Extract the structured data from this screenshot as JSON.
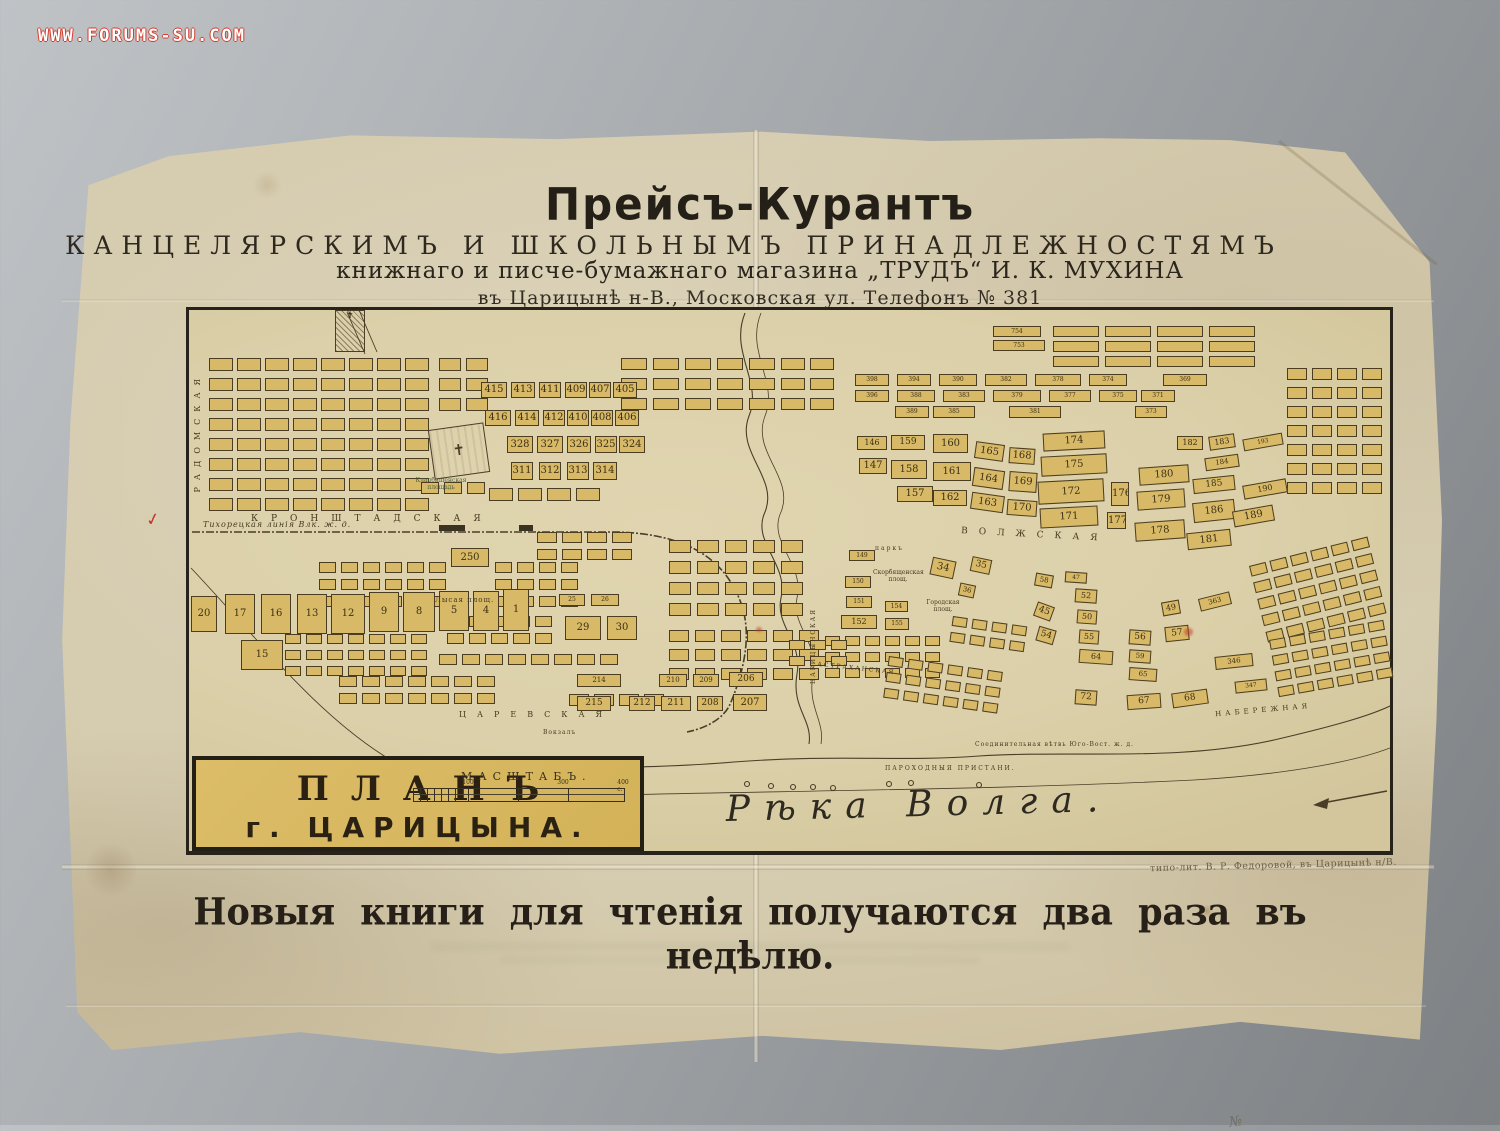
{
  "watermark": "WWW.FORUMS-SU.COM",
  "header": {
    "title": "Прейсъ-Курантъ",
    "line2": "КАНЦЕЛЯРСКИМЪ И ШКОЛЬНЫМЪ ПРИНАДЛЕЖНОСТЯМЪ",
    "line3": "книжнаго и писче-бумажнаго магазина „ТРУДЪ“ И. К. МУХИНА",
    "line4": "въ Царицынѣ н-В., Московская ул. Телефонъ № 381"
  },
  "map": {
    "plan_label_line1": "ПЛАНЪ",
    "plan_label_line2": "г. ЦАРИЦЫНА.",
    "scale": {
      "label": "МАСШТАБЪ.",
      "ticks": [
        [
          "100",
          55
        ],
        [
          "300",
          150
        ],
        [
          "400 с.",
          210
        ]
      ]
    },
    "river_label": "Рѣка Волга.",
    "prison_mark": "✝",
    "cemetery_mark": "✝",
    "pencil_note": "№",
    "red_check": "✓",
    "streets": [
      {
        "t": "РАДОМСКАЯ",
        "x": 4,
        "y": 62,
        "fs": 8,
        "ls": 7,
        "v": 1
      },
      {
        "t": "КРОНШТАДСКАЯ",
        "x": 62,
        "y": 204,
        "fs": 9,
        "ls": 13
      },
      {
        "t": "Тихорецкая линія Влк. ж. д.",
        "x": 14,
        "y": 210,
        "fs": 8,
        "ls": 1,
        "i": 1
      },
      {
        "t": "ВОЛЖСКАЯ",
        "x": 772,
        "y": 220,
        "fs": 9,
        "ls": 11,
        "r": 3
      },
      {
        "t": "ЦАРЕВСКАЯ",
        "x": 270,
        "y": 400,
        "fs": 8,
        "ls": 11
      },
      {
        "t": "НАБЕРЕЖНАЯ",
        "x": 1026,
        "y": 396,
        "fs": 7,
        "ls": 4,
        "r": -5
      },
      {
        "t": "Кладбищенская площадь",
        "x": 220,
        "y": 168,
        "fs": 6,
        "w": 64,
        "c": "#51603a"
      },
      {
        "t": "Лысая площ.",
        "x": 246,
        "y": 286,
        "fs": 7,
        "ls": 1
      },
      {
        "t": "Городская площ.",
        "x": 736,
        "y": 290,
        "fs": 6,
        "w": 36
      },
      {
        "t": "Скорбященская площ.",
        "x": 684,
        "y": 260,
        "fs": 6,
        "w": 50
      },
      {
        "t": "паркъ",
        "x": 686,
        "y": 236,
        "fs": 6,
        "ls": 2
      },
      {
        "t": "АСТРАХАНСКАЯ",
        "x": 628,
        "y": 356,
        "fs": 6,
        "ls": 2,
        "r": 6
      },
      {
        "t": "ЦАРИЦЫНСКАЯ",
        "x": 622,
        "y": 298,
        "fs": 6,
        "ls": 2,
        "v": 1
      },
      {
        "t": "Соединительная вѣтвь Юго-Вост. ж. д.",
        "x": 786,
        "y": 432,
        "fs": 6,
        "ls": 1
      },
      {
        "t": "ПАРОХОДНЫЯ ПРИСТАНИ.",
        "x": 696,
        "y": 456,
        "fs": 6,
        "ls": 2
      },
      {
        "t": "Вокзалъ",
        "x": 354,
        "y": 420,
        "fs": 6,
        "ls": 1
      }
    ],
    "blocks": [
      [
        "20",
        2,
        286,
        26,
        36
      ],
      [
        "17",
        36,
        284,
        30,
        40
      ],
      [
        "16",
        72,
        284,
        30,
        40
      ],
      [
        "13",
        108,
        284,
        30,
        40
      ],
      [
        "12",
        142,
        284,
        34,
        40
      ],
      [
        "9",
        180,
        282,
        30,
        40
      ],
      [
        "8",
        214,
        282,
        32,
        40
      ],
      [
        "5",
        250,
        281,
        30,
        40
      ],
      [
        "4",
        284,
        281,
        26,
        40
      ],
      [
        "1",
        314,
        279,
        26,
        42
      ],
      [
        "15",
        52,
        330,
        42,
        30
      ],
      [
        "250",
        262,
        238,
        38,
        19
      ],
      [
        "25",
        370,
        284,
        26,
        12
      ],
      [
        "26",
        402,
        284,
        28,
        12
      ],
      [
        "29",
        376,
        306,
        36,
        24
      ],
      [
        "30",
        418,
        306,
        30,
        24
      ],
      [
        "214",
        388,
        364,
        44,
        13
      ],
      [
        "210",
        470,
        364,
        28,
        13
      ],
      [
        "209",
        504,
        364,
        26,
        13
      ],
      [
        "206",
        540,
        362,
        34,
        15
      ],
      [
        "215",
        388,
        386,
        34,
        15
      ],
      [
        "212",
        440,
        386,
        26,
        15
      ],
      [
        "211",
        472,
        386,
        30,
        15
      ],
      [
        "208",
        508,
        386,
        26,
        15
      ],
      [
        "207",
        544,
        384,
        34,
        17
      ],
      [
        "415",
        292,
        72,
        26,
        16
      ],
      [
        "413",
        322,
        72,
        24,
        16
      ],
      [
        "411",
        350,
        72,
        22,
        16
      ],
      [
        "409",
        376,
        72,
        22,
        16
      ],
      [
        "407",
        400,
        72,
        22,
        16
      ],
      [
        "405",
        424,
        72,
        24,
        16
      ],
      [
        "416",
        296,
        100,
        26,
        16
      ],
      [
        "414",
        326,
        100,
        24,
        16
      ],
      [
        "412",
        354,
        100,
        22,
        16
      ],
      [
        "410",
        378,
        100,
        22,
        16
      ],
      [
        "408",
        402,
        100,
        22,
        16
      ],
      [
        "406",
        426,
        100,
        24,
        16
      ],
      [
        "328",
        318,
        126,
        26,
        17
      ],
      [
        "327",
        348,
        126,
        26,
        17
      ],
      [
        "326",
        378,
        126,
        24,
        17
      ],
      [
        "325",
        406,
        126,
        22,
        17
      ],
      [
        "324",
        430,
        126,
        26,
        17
      ],
      [
        "311",
        322,
        152,
        22,
        18
      ],
      [
        "312",
        350,
        152,
        22,
        18
      ],
      [
        "313",
        378,
        152,
        22,
        18
      ],
      [
        "314",
        404,
        152,
        24,
        18
      ],
      [
        "398",
        666,
        64,
        34,
        12
      ],
      [
        "394",
        708,
        64,
        34,
        12
      ],
      [
        "390",
        750,
        64,
        38,
        12
      ],
      [
        "382",
        796,
        64,
        42,
        12
      ],
      [
        "378",
        846,
        64,
        46,
        12
      ],
      [
        "374",
        900,
        64,
        38,
        12
      ],
      [
        "369",
        974,
        64,
        44,
        12
      ],
      [
        "396",
        666,
        80,
        34,
        12
      ],
      [
        "388",
        708,
        80,
        38,
        12
      ],
      [
        "383",
        754,
        80,
        42,
        12
      ],
      [
        "379",
        804,
        80,
        48,
        12
      ],
      [
        "377",
        860,
        80,
        42,
        12
      ],
      [
        "375",
        910,
        80,
        38,
        12
      ],
      [
        "371",
        952,
        80,
        34,
        12
      ],
      [
        "389",
        706,
        96,
        34,
        12
      ],
      [
        "385",
        744,
        96,
        42,
        12
      ],
      [
        "381",
        820,
        96,
        52,
        12
      ],
      [
        "373",
        946,
        96,
        32,
        12
      ],
      [
        "754",
        804,
        16,
        48,
        11
      ],
      [
        "753",
        804,
        30,
        52,
        11
      ],
      [
        "146",
        668,
        126,
        30,
        14
      ],
      [
        "147",
        670,
        148,
        28,
        16
      ],
      [
        "159",
        702,
        125,
        34,
        15
      ],
      [
        "158",
        702,
        150,
        36,
        19
      ],
      [
        "157",
        708,
        176,
        36,
        16
      ],
      [
        "160",
        744,
        124,
        35,
        19
      ],
      [
        "161",
        744,
        152,
        38,
        19
      ],
      [
        "162",
        744,
        180,
        34,
        16
      ],
      [
        "165",
        786,
        133,
        29,
        17,
        8
      ],
      [
        "164",
        784,
        159,
        31,
        19,
        8
      ],
      [
        "163",
        782,
        184,
        33,
        17,
        8
      ],
      [
        "168",
        820,
        138,
        26,
        16,
        4
      ],
      [
        "169",
        820,
        162,
        28,
        20,
        4
      ],
      [
        "170",
        818,
        190,
        30,
        16,
        4
      ],
      [
        "174",
        854,
        122,
        62,
        18,
        -3
      ],
      [
        "175",
        852,
        145,
        66,
        20,
        -3
      ],
      [
        "172",
        849,
        170,
        66,
        23,
        -3
      ],
      [
        "171",
        851,
        197,
        58,
        20,
        -3
      ],
      [
        "176",
        922,
        172,
        18,
        24
      ],
      [
        "177",
        918,
        202,
        19,
        17
      ],
      [
        "180",
        950,
        156,
        50,
        18,
        -4
      ],
      [
        "179",
        948,
        180,
        48,
        19,
        -4
      ],
      [
        "178",
        946,
        211,
        50,
        19,
        -4
      ],
      [
        "181",
        998,
        221,
        44,
        17,
        -6
      ],
      [
        "185",
        1004,
        167,
        42,
        15,
        -6
      ],
      [
        "186",
        1004,
        191,
        42,
        20,
        -6
      ],
      [
        "184",
        1016,
        146,
        34,
        13,
        -8
      ],
      [
        "182",
        988,
        126,
        26,
        14
      ],
      [
        "183",
        1020,
        125,
        26,
        14,
        -8
      ],
      [
        "193",
        1054,
        126,
        40,
        12,
        -10
      ],
      [
        "190",
        1054,
        172,
        44,
        14,
        -10
      ],
      [
        "189",
        1044,
        198,
        41,
        16,
        -10
      ],
      [
        "34",
        742,
        249,
        24,
        18,
        12
      ],
      [
        "35",
        782,
        248,
        20,
        15,
        12
      ],
      [
        "36",
        770,
        274,
        16,
        13,
        12
      ],
      [
        "45",
        846,
        294,
        18,
        15,
        20
      ],
      [
        "47",
        876,
        262,
        22,
        11,
        4
      ],
      [
        "52",
        886,
        279,
        22,
        14,
        4
      ],
      [
        "50",
        888,
        300,
        20,
        14,
        4
      ],
      [
        "55",
        890,
        320,
        20,
        14,
        4
      ],
      [
        "54",
        848,
        318,
        18,
        15,
        16
      ],
      [
        "58",
        846,
        264,
        18,
        13,
        10
      ],
      [
        "56",
        940,
        320,
        22,
        15,
        4
      ],
      [
        "57",
        976,
        316,
        24,
        15,
        -6
      ],
      [
        "59",
        940,
        340,
        22,
        13,
        4
      ],
      [
        "64",
        890,
        340,
        34,
        14,
        4
      ],
      [
        "65",
        940,
        358,
        28,
        13,
        4
      ],
      [
        "67",
        938,
        384,
        34,
        15,
        -4
      ],
      [
        "68",
        983,
        381,
        36,
        15,
        -8
      ],
      [
        "72",
        886,
        380,
        22,
        15,
        4
      ],
      [
        "149",
        660,
        240,
        26,
        11
      ],
      [
        "150",
        656,
        266,
        26,
        12
      ],
      [
        "151",
        657,
        286,
        26,
        12
      ],
      [
        "152",
        652,
        305,
        36,
        14
      ],
      [
        "154",
        696,
        291,
        23,
        11
      ],
      [
        "155",
        696,
        308,
        24,
        12
      ],
      [
        "346",
        1026,
        345,
        38,
        13,
        -6
      ],
      [
        "347",
        1046,
        370,
        32,
        12,
        -6
      ],
      [
        "363",
        1010,
        285,
        32,
        13,
        -14
      ],
      [
        "49",
        973,
        291,
        18,
        14,
        -10
      ]
    ],
    "clusters": [
      [
        20,
        48,
        8,
        8,
        24,
        13,
        4,
        7
      ],
      [
        250,
        48,
        2,
        3,
        22,
        13,
        5,
        7
      ],
      [
        432,
        48,
        5,
        3,
        26,
        12,
        6,
        8
      ],
      [
        592,
        48,
        2,
        3,
        24,
        12,
        5,
        8
      ],
      [
        232,
        172,
        3,
        1,
        18,
        12,
        5,
        6
      ],
      [
        300,
        178,
        4,
        1,
        24,
        13,
        5,
        6
      ],
      [
        348,
        222,
        4,
        2,
        20,
        11,
        5,
        6
      ],
      [
        130,
        252,
        6,
        3,
        17,
        11,
        5,
        6
      ],
      [
        306,
        252,
        4,
        3,
        17,
        11,
        5,
        6
      ],
      [
        258,
        306,
        5,
        2,
        17,
        11,
        5,
        6
      ],
      [
        96,
        324,
        7,
        3,
        16,
        10,
        5,
        6
      ],
      [
        250,
        344,
        8,
        1,
        18,
        11,
        5,
        6
      ],
      [
        150,
        366,
        7,
        2,
        18,
        11,
        5,
        6
      ],
      [
        380,
        384,
        4,
        1,
        20,
        12,
        5,
        6
      ],
      [
        480,
        230,
        5,
        4,
        22,
        13,
        6,
        8
      ],
      [
        480,
        320,
        6,
        3,
        20,
        12,
        6,
        7
      ],
      [
        636,
        326,
        6,
        3,
        15,
        10,
        5,
        6
      ],
      [
        700,
        346,
        6,
        3,
        15,
        10,
        5,
        6,
        8
      ],
      [
        764,
        306,
        4,
        2,
        15,
        10,
        5,
        6,
        8
      ],
      [
        600,
        330,
        3,
        2,
        16,
        10,
        5,
        6
      ],
      [
        864,
        16,
        4,
        3,
        46,
        11,
        6,
        4
      ],
      [
        1098,
        58,
        4,
        7,
        20,
        12,
        5,
        7
      ],
      [
        1060,
        256,
        6,
        5,
        17,
        11,
        4,
        6,
        -14
      ],
      [
        1080,
        330,
        6,
        4,
        16,
        10,
        4,
        6,
        -10
      ]
    ]
  },
  "imprint": "типо-лит. В. Р. Федоровой, въ Царицынѣ н/В.",
  "slogan": "Новыя книги для чтенія получаются два раза въ недѣлю."
}
